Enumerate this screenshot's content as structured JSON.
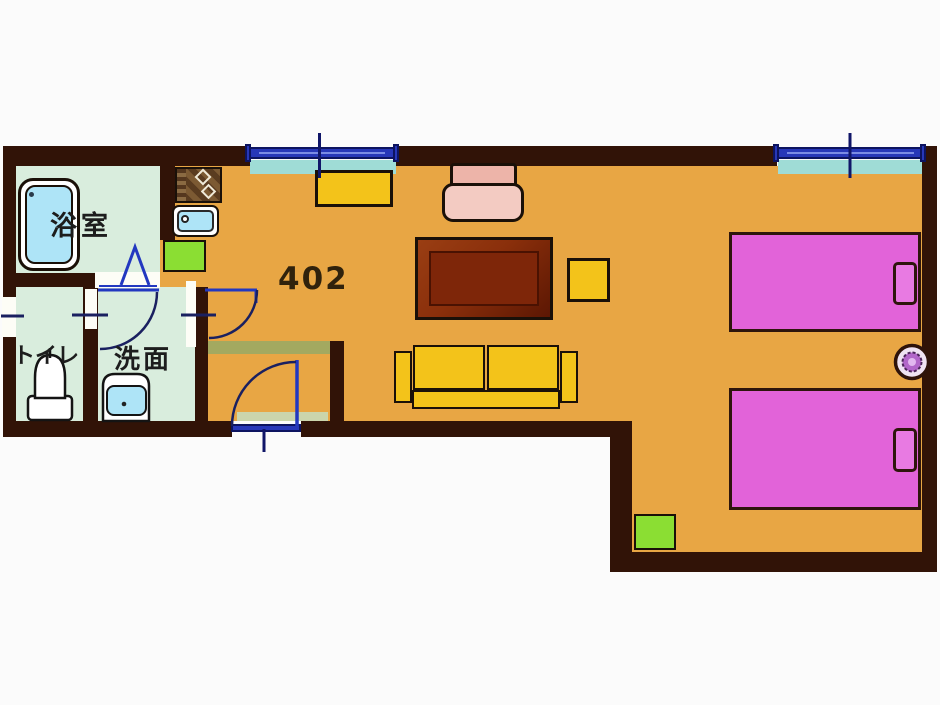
{
  "plan": {
    "room_number": "402",
    "labels": {
      "bath": "浴室",
      "toilet": "トイレ",
      "washroom": "洗面"
    }
  },
  "palette": {
    "floor": "#E8A644",
    "wall": "#311307",
    "wet_room_floor": "#D9EDDD",
    "bed": "#E263D9",
    "pillow": "#E87AE2",
    "sofa_yellow": "#F3C31A",
    "table_brown": "#7E2609",
    "table_bevel": "#9A3E13",
    "chair_pink": "#F3CBC2",
    "chair_pink_dark": "#EDB4A9",
    "green_mat": "#8BDE33",
    "window_blue": "#2737B8",
    "window_frame": "#0D1460",
    "sill_cyan": "#9FDCD6",
    "door_blue": "#2238C0",
    "arc_blue": "#1A2060",
    "tick_blue": "#101668",
    "tub_blue": "#AEE4F7",
    "step_olive": "#A3A960",
    "entry_strip": "#CBD5AC",
    "stool_purple": "#B267C9",
    "outline": "#1A1008",
    "label_color": "#1D1D1D",
    "number_color": "#30220C"
  },
  "elements": {
    "bathtub": "rounded-rect",
    "kitchen_stove": "checker-rect",
    "kitchen_sink": "rounded-rect",
    "wash_basin": "rounded-rect",
    "toilet_bowl": "dome-on-base",
    "single_bed": "rect-with-pillow",
    "sofa": "three-part-rect",
    "low_table": "beveled-rect",
    "armchair": "rounded-rect",
    "tv_board": "rect",
    "side_table": "square",
    "floor_mat": "green-square",
    "stool": "flower-circle",
    "door_swing": "quarter-arc",
    "folding_door": "lambda-lines",
    "window": "blue-bar"
  }
}
